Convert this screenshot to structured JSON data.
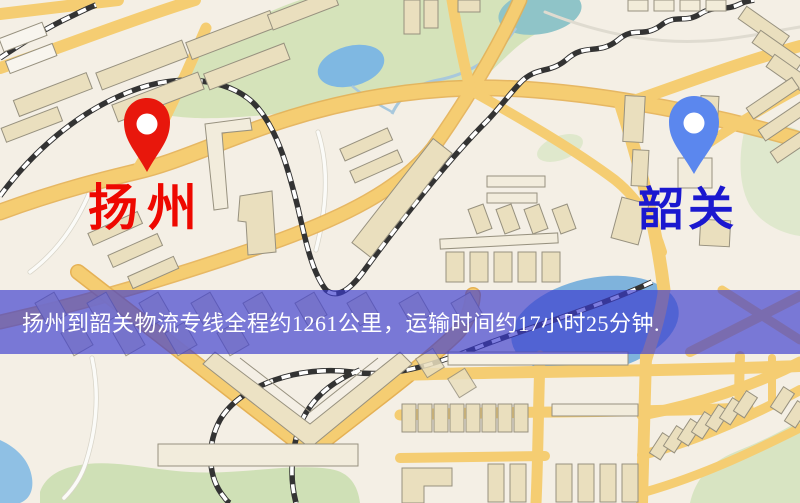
{
  "map": {
    "markers": [
      {
        "role": "origin",
        "label": "扬州",
        "pin_color": "#e8170c",
        "label_color": "#ee0800"
      },
      {
        "role": "destination",
        "label": "韶关",
        "pin_color": "#5b87ee",
        "label_color": "#1b18cf"
      }
    ],
    "banner": {
      "text": "扬州到韶关物流专线全程约1261公里，运输时间约17小时25分钟.",
      "background": "rgba(58,58,206,0.66)",
      "text_color": "#ffffff"
    },
    "route": {
      "origin": "扬州",
      "destination": "韶关",
      "distance_text": "约1261公里",
      "duration_text": "约17小时25分钟"
    },
    "colors": {
      "land": "#f4efe5",
      "road_major": "#f5cd72",
      "road_casing": "#e5b155",
      "park": "#d5e3ba",
      "water": "#85b9e0",
      "building": "#eadfbe",
      "railway": "#333333"
    }
  }
}
